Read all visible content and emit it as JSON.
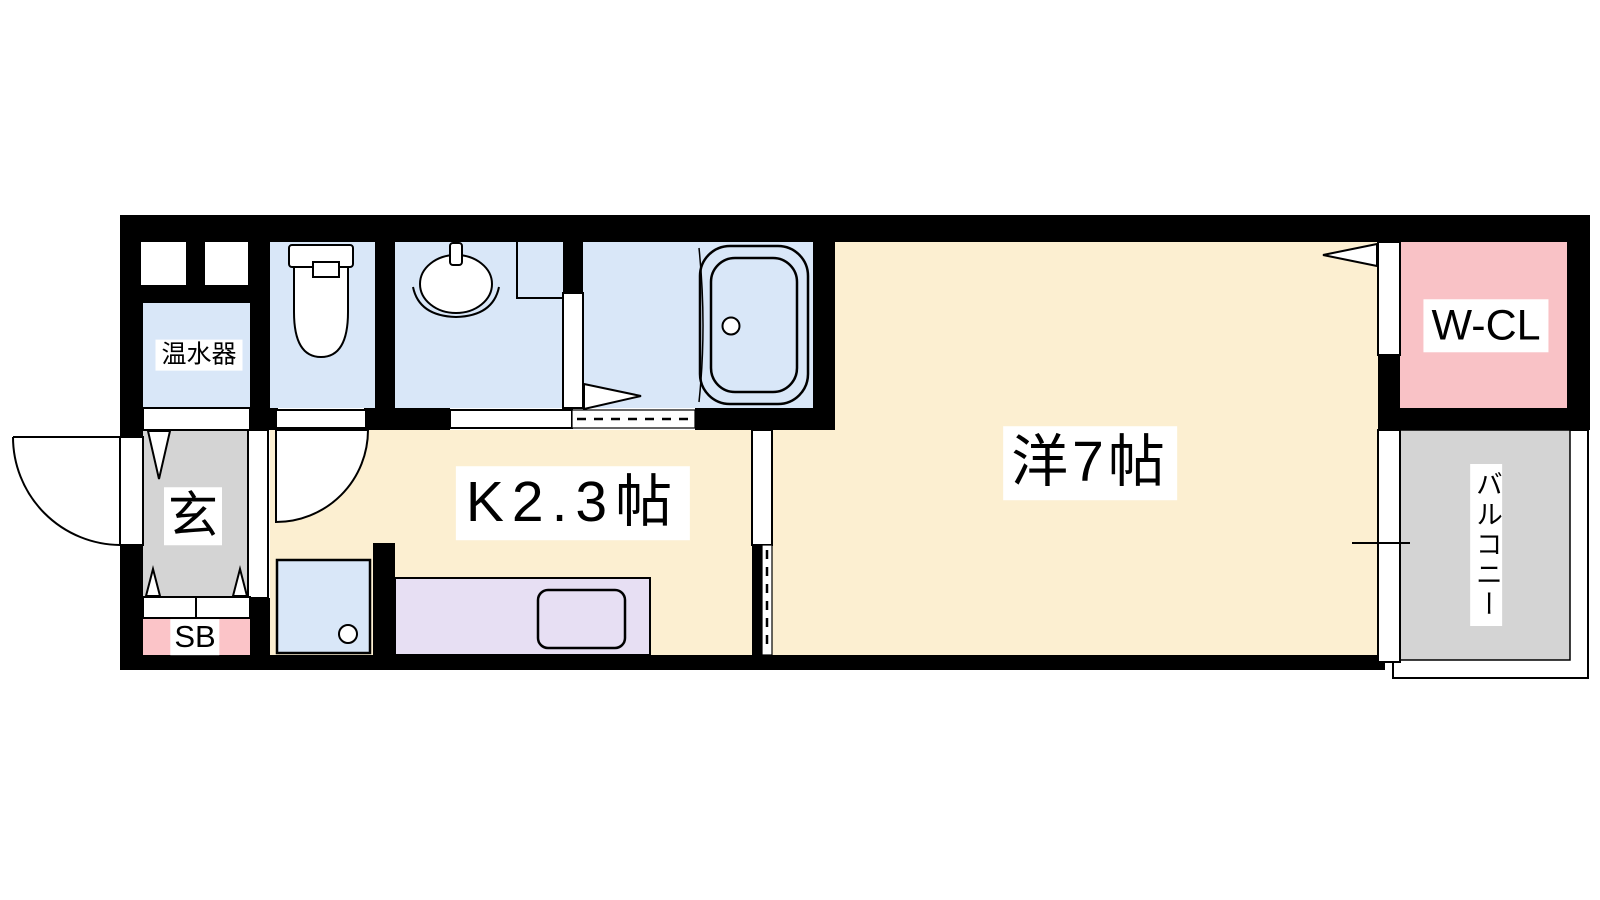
{
  "plan": {
    "rooms": {
      "water_heater": {
        "label": "温水器"
      },
      "entrance": {
        "label": "玄"
      },
      "shoe_box": {
        "label": "SB"
      },
      "kitchen": {
        "label": "K2.3帖"
      },
      "western_room": {
        "label": "洋7帖"
      },
      "walk_in_closet": {
        "label": "W-CL"
      },
      "balcony": {
        "label": "バルコニー"
      }
    },
    "fixtures": [
      "toilet",
      "washbasin",
      "bathtub",
      "kitchen-sink",
      "washing-machine-pan",
      "entrance-door",
      "room-door-arc",
      "sliding-door",
      "folding-door-arrow",
      "sliding-window",
      "water-heater"
    ],
    "colors": {
      "wall": "#000000",
      "room_cream": "#FCEFD1",
      "sanitary_blue": "#D9E7F8",
      "counter_lavender": "#E7DFF3",
      "closet_pink": "#F9C2C6",
      "shoebox_pink": "#FBC4C8",
      "entrance_gray": "#D4D4D4",
      "balcony_gray": "#D4D4D4",
      "label_bg": "#FFFFFF",
      "background": "#FFFFFF"
    }
  }
}
